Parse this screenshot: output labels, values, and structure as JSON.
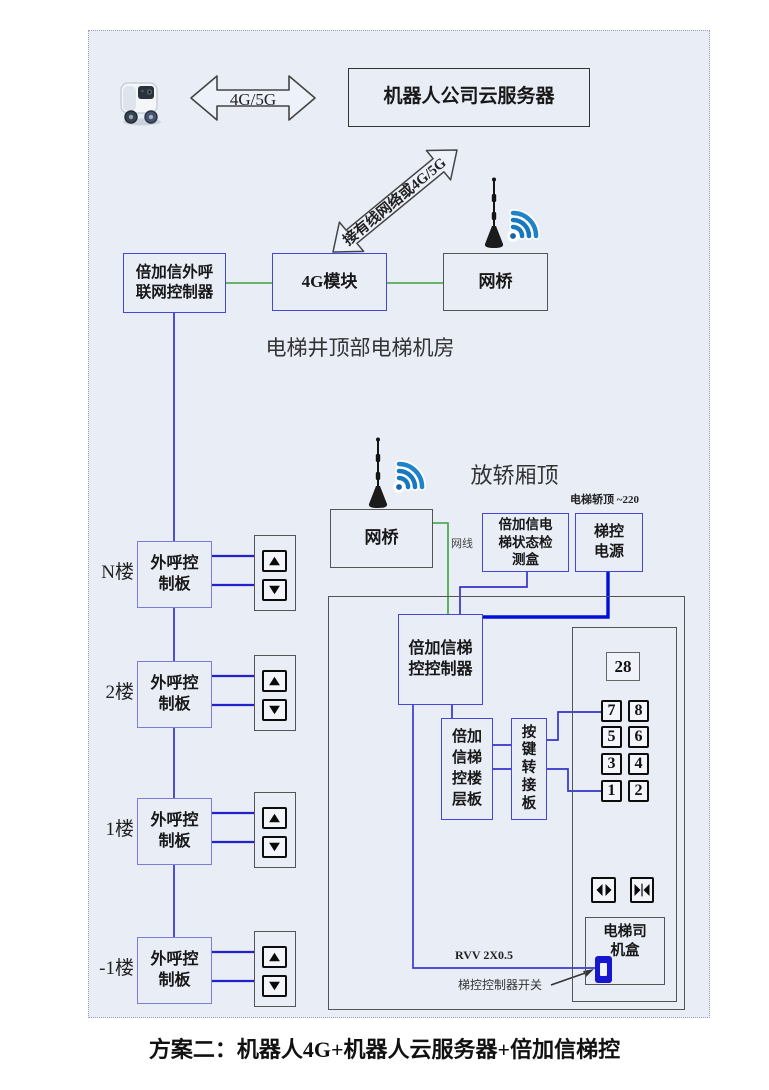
{
  "caption": "方案二：机器人4G+机器人云服务器+倍加信梯控",
  "top": {
    "robot_icon": "delivery-robot-icon",
    "link_label": "4G/5G",
    "cloud_server": "机器人公司云服务器",
    "diagonal_link_label": "接有线网络或4G/5G"
  },
  "machine_room": {
    "caption": "电梯井顶部电梯机房",
    "outcall_controller": "倍加信外呼\n联网控制器",
    "module_4g": "4G模块",
    "bridge": "网桥",
    "antenna_icon": "antenna-icon",
    "wifi_icon": "wifi-signal-icon"
  },
  "car_top": {
    "caption": "放轿厢顶",
    "bridge": "网桥",
    "cable_label": "网线",
    "status_box": "倍加信电\n梯状态检\n测盒",
    "power": "梯控\n电源",
    "power_note": "电梯轿顶 ~220",
    "antenna_icon": "antenna-icon",
    "wifi_icon": "wifi-signal-icon"
  },
  "control": {
    "controller": "倍加信梯\n控控制器",
    "floor_board": "倍加\n信梯\n控楼\n层板",
    "key_adapter": "按\n键\n转\n接\n板",
    "display": "28",
    "buttons": [
      [
        "7",
        "8"
      ],
      [
        "5",
        "6"
      ],
      [
        "3",
        "4"
      ],
      [
        "1",
        "2"
      ]
    ],
    "door_open_icon": "door-open-icon",
    "door_close_icon": "door-close-icon",
    "driver_box": "电梯司\n机盒",
    "switch_icon": "toggle-switch-icon",
    "wire_label": "RVV 2X0.5",
    "switch_label": "梯控控制器开关"
  },
  "floors": [
    {
      "label": "N楼",
      "board": "外呼控\n制板",
      "up_icon": "up-arrow-icon",
      "down_icon": "down-arrow-icon"
    },
    {
      "label": "2楼",
      "board": "外呼控\n制板",
      "up_icon": "up-arrow-icon",
      "down_icon": "down-arrow-icon"
    },
    {
      "label": "1楼",
      "board": "外呼控\n制板",
      "up_icon": "up-arrow-icon",
      "down_icon": "down-arrow-icon"
    },
    {
      "label": "-1楼",
      "board": "外呼控\n制板",
      "up_icon": "up-arrow-icon",
      "down_icon": "down-arrow-icon"
    }
  ],
  "colors": {
    "background": "#e8edf6",
    "wire_blue": "#3333cc",
    "wire_green": "#3da03d",
    "power_blue": "#0010d8",
    "box_blue_border": "#4646dc",
    "box_purple_border": "#7c7cdc",
    "box_gray_border": "#555555",
    "wifi_blue": "#1878be",
    "switch_blue": "#1717d0"
  }
}
